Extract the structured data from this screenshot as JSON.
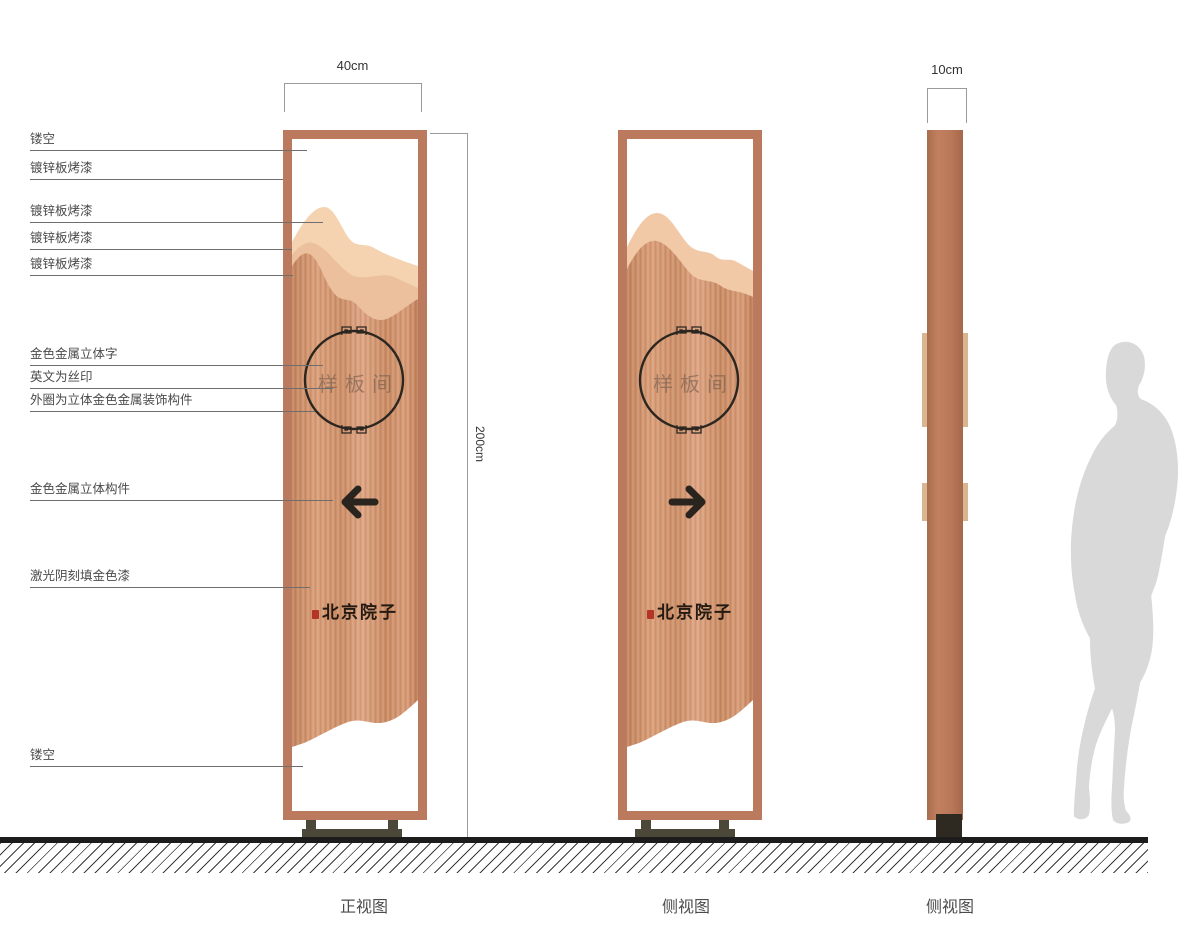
{
  "annotations": [
    {
      "label": "镂空"
    },
    {
      "label": "镀锌板烤漆"
    },
    {
      "label": "镀锌板烤漆"
    },
    {
      "label": "镀锌板烤漆"
    },
    {
      "label": "镀锌板烤漆"
    },
    {
      "label": "金色金属立体字"
    },
    {
      "label": "英文为丝印"
    },
    {
      "label": "外圈为立体金色金属装饰构件"
    },
    {
      "label": "金色金属立体构件"
    },
    {
      "label": "激光阴刻填金色漆"
    },
    {
      "label": "镂空"
    }
  ],
  "dimensions": {
    "front_width": "40cm",
    "height": "200cm",
    "depth": "10cm"
  },
  "sign": {
    "room_label": "样板间",
    "brand": "北京院子"
  },
  "captions": {
    "front": "正视图",
    "side": "侧视图",
    "profile": "侧视图"
  },
  "colors": {
    "copper_frame": "#bb7a5e",
    "copper_body": "#cf9470",
    "mountain_light": "#f5d2b0",
    "mountain_mid": "#ecc09c",
    "base_metal": "#4b4839",
    "ink": "#2c2620",
    "seal_red": "#b23525",
    "silhouette_gray": "#d9d9d9"
  }
}
